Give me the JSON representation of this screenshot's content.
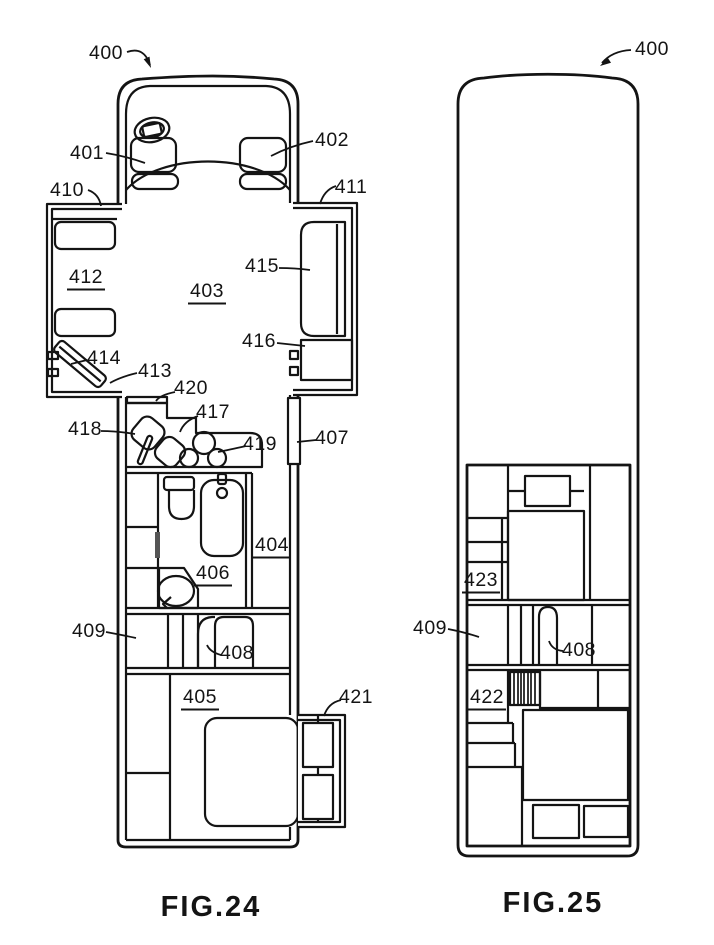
{
  "colors": {
    "ink": "#141414",
    "paper": "#ffffff",
    "door_marker": "#555555"
  },
  "captions": {
    "fig24": "FIG.24",
    "fig25": "FIG.25"
  },
  "fig24": {
    "labels": [
      {
        "text": "400",
        "x": 106,
        "y": 59,
        "leader": "M127,52 Q144,46 150,65",
        "arrow": "151,68 143.7,59.2 149.5,56.6"
      },
      {
        "text": "401",
        "x": 87,
        "y": 159,
        "leader": "M106,153 Q125,156 145,163"
      },
      {
        "text": "402",
        "x": 332,
        "y": 146,
        "leader": "M313,141 Q290,146 271,156"
      },
      {
        "text": "410",
        "x": 67,
        "y": 196,
        "leader": "M88,190 Q99,194 101,206"
      },
      {
        "text": "411",
        "x": 351,
        "y": 193,
        "leader": "M336,186 Q324,190 320,204"
      },
      {
        "text": "412",
        "x": 86,
        "y": 283,
        "underline": true
      },
      {
        "text": "403",
        "x": 207,
        "y": 297,
        "underline": true
      },
      {
        "text": "415",
        "x": 262,
        "y": 272,
        "leader": "M279,268 Q295,268 310,270"
      },
      {
        "text": "416",
        "x": 259,
        "y": 347,
        "leader": "M277,343 L305,346"
      },
      {
        "text": "414",
        "x": 104,
        "y": 364,
        "leader": "M87,360 L71,364"
      },
      {
        "text": "413",
        "x": 155,
        "y": 377,
        "leader": "M137,373 Q120,377 110,383"
      },
      {
        "text": "420",
        "x": 191,
        "y": 394,
        "leader": "M175,392 Q160,395 156,401"
      },
      {
        "text": "417",
        "x": 213,
        "y": 418,
        "leader": "M198,416 Q184,421 180,432"
      },
      {
        "text": "418",
        "x": 85,
        "y": 435,
        "leader": "M101,431 Q117,431 135,434"
      },
      {
        "text": "419",
        "x": 260,
        "y": 450,
        "leader": "M246,446 Q228,450 218,452"
      },
      {
        "text": "407",
        "x": 332,
        "y": 444,
        "leader": "M316,440 L297,442"
      },
      {
        "text": "404",
        "x": 272,
        "y": 551,
        "underline": true
      },
      {
        "text": "406",
        "x": 213,
        "y": 579,
        "underline": true
      },
      {
        "text": "409",
        "x": 89,
        "y": 637,
        "leader": "M106,632 Q122,635 136,638"
      },
      {
        "text": "408",
        "x": 237,
        "y": 659,
        "leader": "M221,655 Q210,652 207,645"
      },
      {
        "text": "405",
        "x": 200,
        "y": 703,
        "underline": true
      },
      {
        "text": "421",
        "x": 356,
        "y": 703,
        "leader": "M341,700 Q328,703 324,716"
      }
    ]
  },
  "fig25": {
    "labels": [
      {
        "text": "400",
        "x": 652,
        "y": 55,
        "leader": "M631,50 Q612,51 602,63",
        "arrow": "600,66 607.4,57.3 611,62.7"
      },
      {
        "text": "423",
        "x": 481,
        "y": 586,
        "underline": true
      },
      {
        "text": "409",
        "x": 430,
        "y": 634,
        "leader": "M448,629 Q464,632 479,637"
      },
      {
        "text": "408",
        "x": 579,
        "y": 656,
        "leader": "M563,651 Q552,650 549,641"
      },
      {
        "text": "422",
        "x": 487,
        "y": 703,
        "underline": true
      }
    ]
  }
}
